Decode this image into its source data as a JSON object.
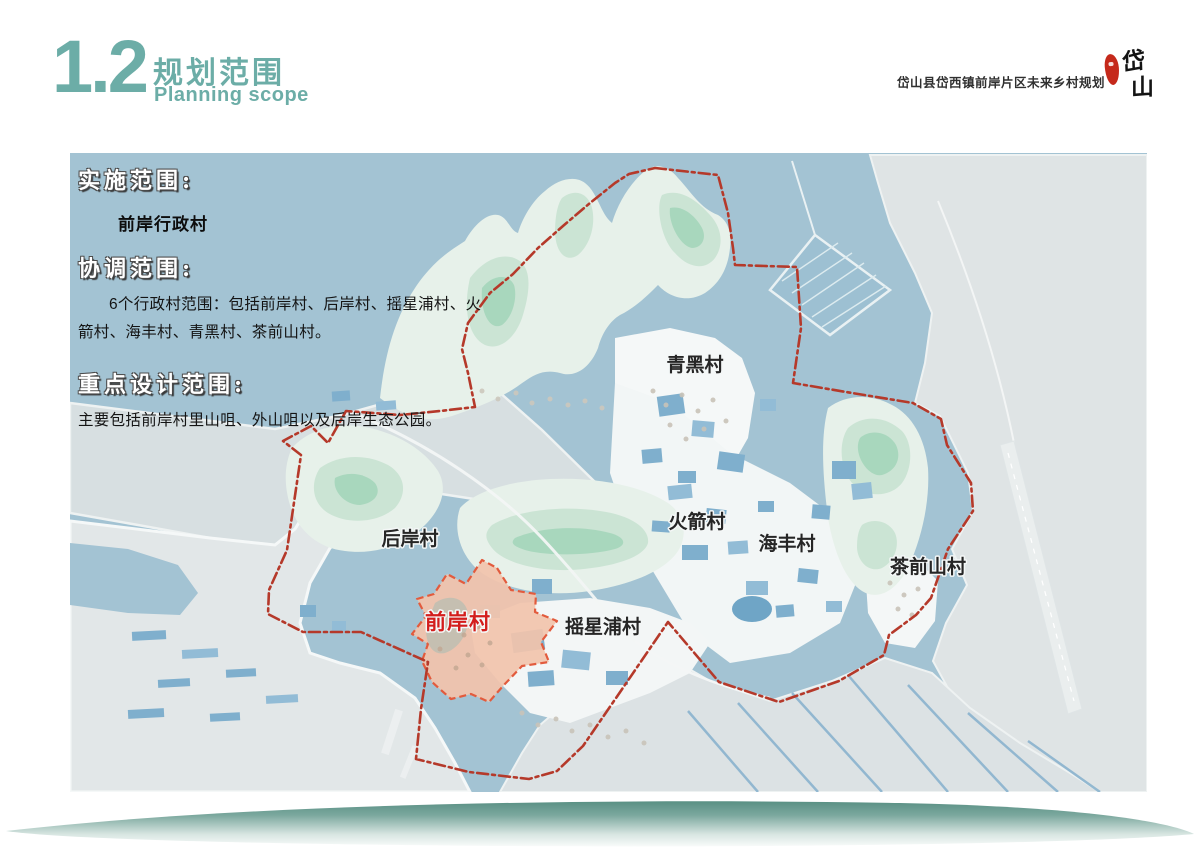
{
  "header": {
    "section_number": "1.2",
    "title_zh": "规划范围",
    "title_en": "Planning scope",
    "project_name": "岱山县岱西镇前岸片区未来乡村规划",
    "seal": {
      "char_top": "岱",
      "char_bottom": "山"
    }
  },
  "overlay": {
    "implementation": {
      "label": "实施范围:",
      "value": "前岸行政村"
    },
    "coordination": {
      "label": "协调范围:",
      "text": "6个行政村范围：包括前岸村、后岸村、摇星浦村、火箭村、海丰村、青黑村、茶前山村。"
    },
    "key_design": {
      "label": "重点设计范围:",
      "text": "主要包括前岸村里山咀、外山咀以及后岸生态公园。"
    }
  },
  "map": {
    "villages": [
      {
        "name": "青黑村"
      },
      {
        "name": "后岸村"
      },
      {
        "name": "火箭村"
      },
      {
        "name": "海丰村"
      },
      {
        "name": "茶前山村"
      },
      {
        "name": "摇星浦村"
      }
    ],
    "highlight_village": {
      "name": "前岸村"
    },
    "colors": {
      "water": "#a3c3d3",
      "boundary_red": "#b5392a",
      "highlight_fill": "#f2c3ab",
      "highlight_label": "#d31d1c",
      "accent_teal": "#6cada7"
    }
  }
}
